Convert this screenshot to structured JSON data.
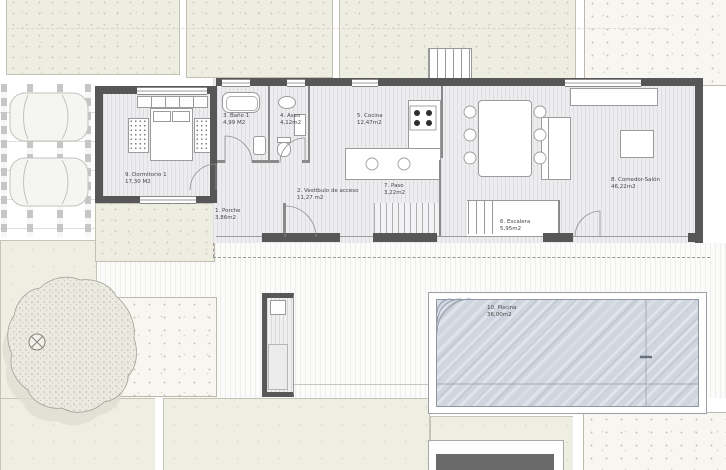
{
  "plan": {
    "kind": "architectural floor plan, ground floor with pool and carport"
  },
  "rooms": {
    "porche": {
      "name": "1. Porche",
      "area": "3,86m2"
    },
    "vestibulo": {
      "name": "2. Vestíbulo de acceso",
      "area": "11,27 m2"
    },
    "bano": {
      "name": "3. Baño 1",
      "area": "4,99 M2"
    },
    "aseo": {
      "name": "4. Aseo",
      "area": "4,12m2"
    },
    "cocina": {
      "name": "5. Cocina",
      "area": "12,47m2"
    },
    "escalera": {
      "name": "6. Escalera",
      "area": "5,95m2"
    },
    "paso": {
      "name": "7. Paso",
      "area": "3,22m2"
    },
    "comedor": {
      "name": "8. Comedor-Salón",
      "area": "46,22m2"
    },
    "dormitorio": {
      "name": "9. Dormitorio 1",
      "area": "17,30 M2"
    },
    "piscina": {
      "name": "10. Piscina",
      "area": "36,00m2"
    }
  },
  "colors": {
    "wall": "#575757",
    "pool_water": "#d0d6df",
    "plot_beige": "#efeee3",
    "floor_gray": "#ededf0"
  }
}
